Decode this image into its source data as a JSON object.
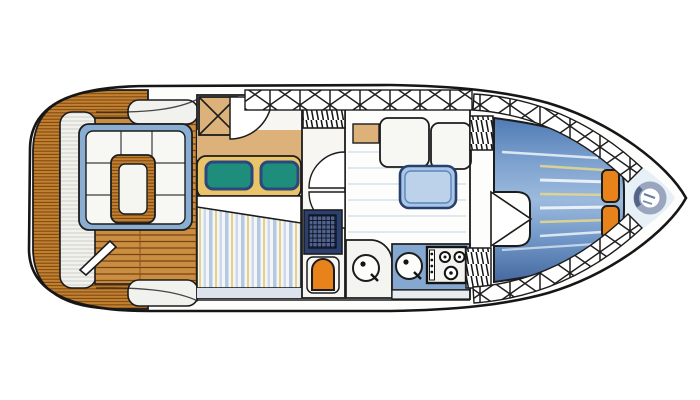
{
  "illustration": {
    "kind": "yacht-deck-floor-plan-watercolor",
    "view": "top-down, bow pointing right",
    "background": "#ffffff"
  },
  "colors": {
    "ink": "#1c1c1c",
    "hull_white": "#fdfdfb",
    "pale_bow_deck": "#e4edf6",
    "teak_base": "#c1812f",
    "teak_line": "#7a4312",
    "bench_white": "#f1f1ee",
    "cushion_white": "#f7f7f4",
    "seat_trim_blue": "#8aaed2",
    "table_wood": "#c98e41",
    "table_top": "#f5f5f2",
    "cabinet_tan": "#dcb27a",
    "mattress_yellow": "#e9c468",
    "pillow_teal": "#1f8d7c",
    "pillow_edge_blue": "#2c477e",
    "duvet_white": "#f3f5f8",
    "walkway_grey": "#dde3ec",
    "navy_panel": "#2c4070",
    "toilet_orange": "#e8831c",
    "salon_table_blue": "#a9c6e6",
    "salon_table_edge": "#27406e",
    "galley_counter_blue": "#85a8d0",
    "stove_white": "#f2f2ef",
    "berth_blue_deep": "#46699f",
    "berth_blue_light": "#8fb1d8",
    "berth_streak_yellow": "#e8d88a",
    "bow_cushion_orange": "#e8831c",
    "windlass_grey": "#95a3ba",
    "windlass_dark": "#4a5d82",
    "floor_line_blue": "#c9d6e4"
  },
  "features": {
    "hull": "hull outline",
    "swim_platform": "teak aft platform",
    "stern_bench": "stern bench",
    "cockpit": "teak cockpit with U-seating and table",
    "aft_cabin": "aft double cabin",
    "head": "head with shower grate and toilet",
    "salon": "salon settee and table",
    "galley": "galley with twin sinks and stove",
    "v_berth": "forward V-berth",
    "bow": "bow deck with windlass",
    "railings": "cross-braced rail panels"
  }
}
